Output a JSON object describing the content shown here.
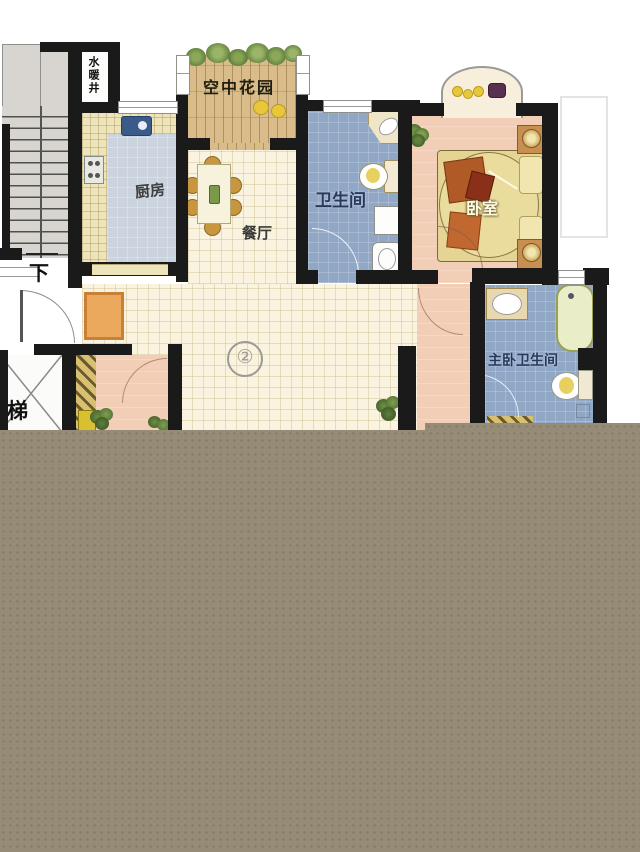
{
  "floorplan": {
    "unit_marker": "②",
    "rooms": {
      "water_shaft": "水暖井",
      "sky_garden": "空中花园",
      "kitchen": "厨房",
      "dining": "餐厅",
      "bathroom": "卫生间",
      "bedroom": "卧室",
      "master_bathroom": "主卧卫生间"
    },
    "annotations": {
      "stairs_down": "下",
      "elevator": "梯"
    },
    "palette": {
      "wall": "#1a1a1a",
      "living_floor": "#f9f3df",
      "kitchen_floor": "#cad3de",
      "counter": "#ede4ba",
      "bath_floor": "#90a7c6",
      "bedroom_floor": "#f3ceb6",
      "garden_wood": "#d9bc8a",
      "stairs": "#d8d5d0",
      "doormat": "#eba95e",
      "masked_overlay": "#958b76"
    }
  }
}
